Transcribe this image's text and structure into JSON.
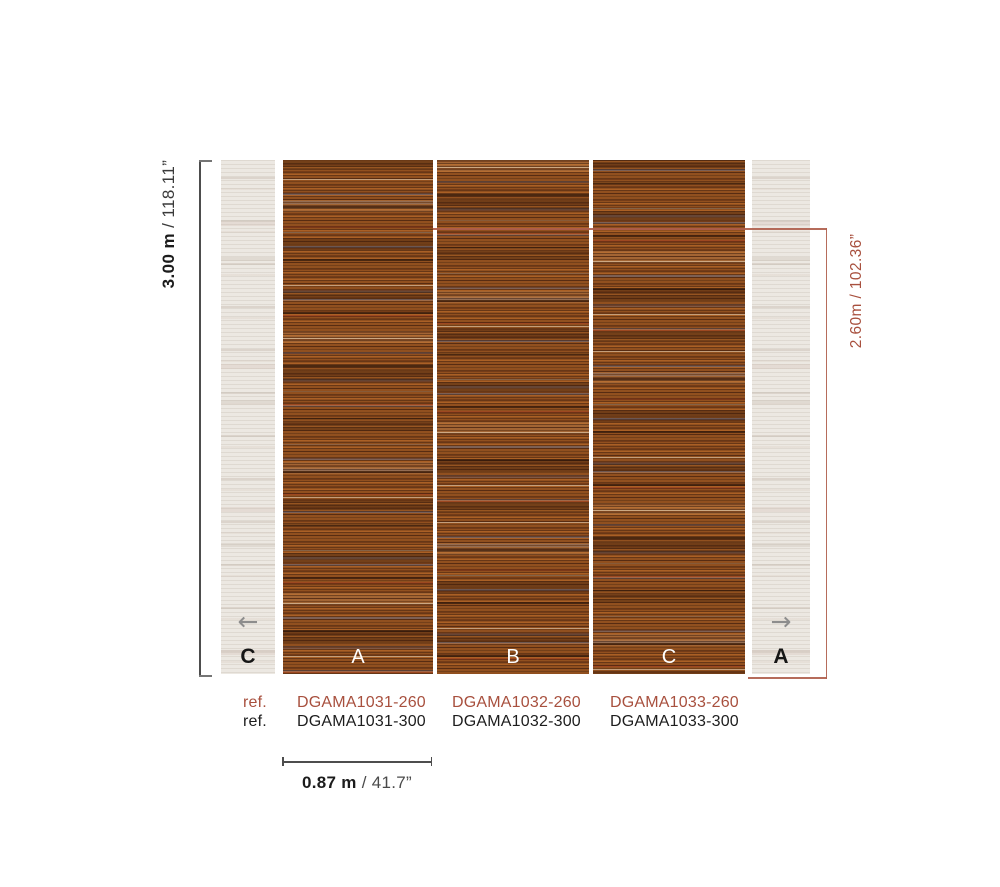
{
  "diagram_title": "wallpaper-panel-dimension-diagram",
  "colors": {
    "accent_red": "#a8503e",
    "text_dark": "#1c1c1c",
    "line_gray": "#4d4d4d",
    "arrow_gray": "#8d8d8d",
    "panel_rust": "#91501f",
    "panel_faded": "#ece8e2"
  },
  "dims": {
    "height_full": {
      "value": "3.00 m",
      "inches": " / 118.11”"
    },
    "height_cut": {
      "value": "2.60m / 102.36”"
    },
    "width": {
      "value": "0.87 m",
      "inches": " / 41.7”"
    }
  },
  "panels": {
    "left_side": {
      "letter": "C"
    },
    "strips": [
      {
        "letter": "A"
      },
      {
        "letter": "B"
      },
      {
        "letter": "C"
      }
    ],
    "right_side": {
      "letter": "A"
    }
  },
  "icons": {
    "left_arrow": "←",
    "right_arrow": "→"
  },
  "references": {
    "label_260": "ref.",
    "label_300": "ref.",
    "row_260": [
      "DGAMA1031-260",
      "DGAMA1032-260",
      "DGAMA1033-260"
    ],
    "row_300": [
      "DGAMA1031-300",
      "DGAMA1032-300",
      "DGAMA1033-300"
    ]
  }
}
